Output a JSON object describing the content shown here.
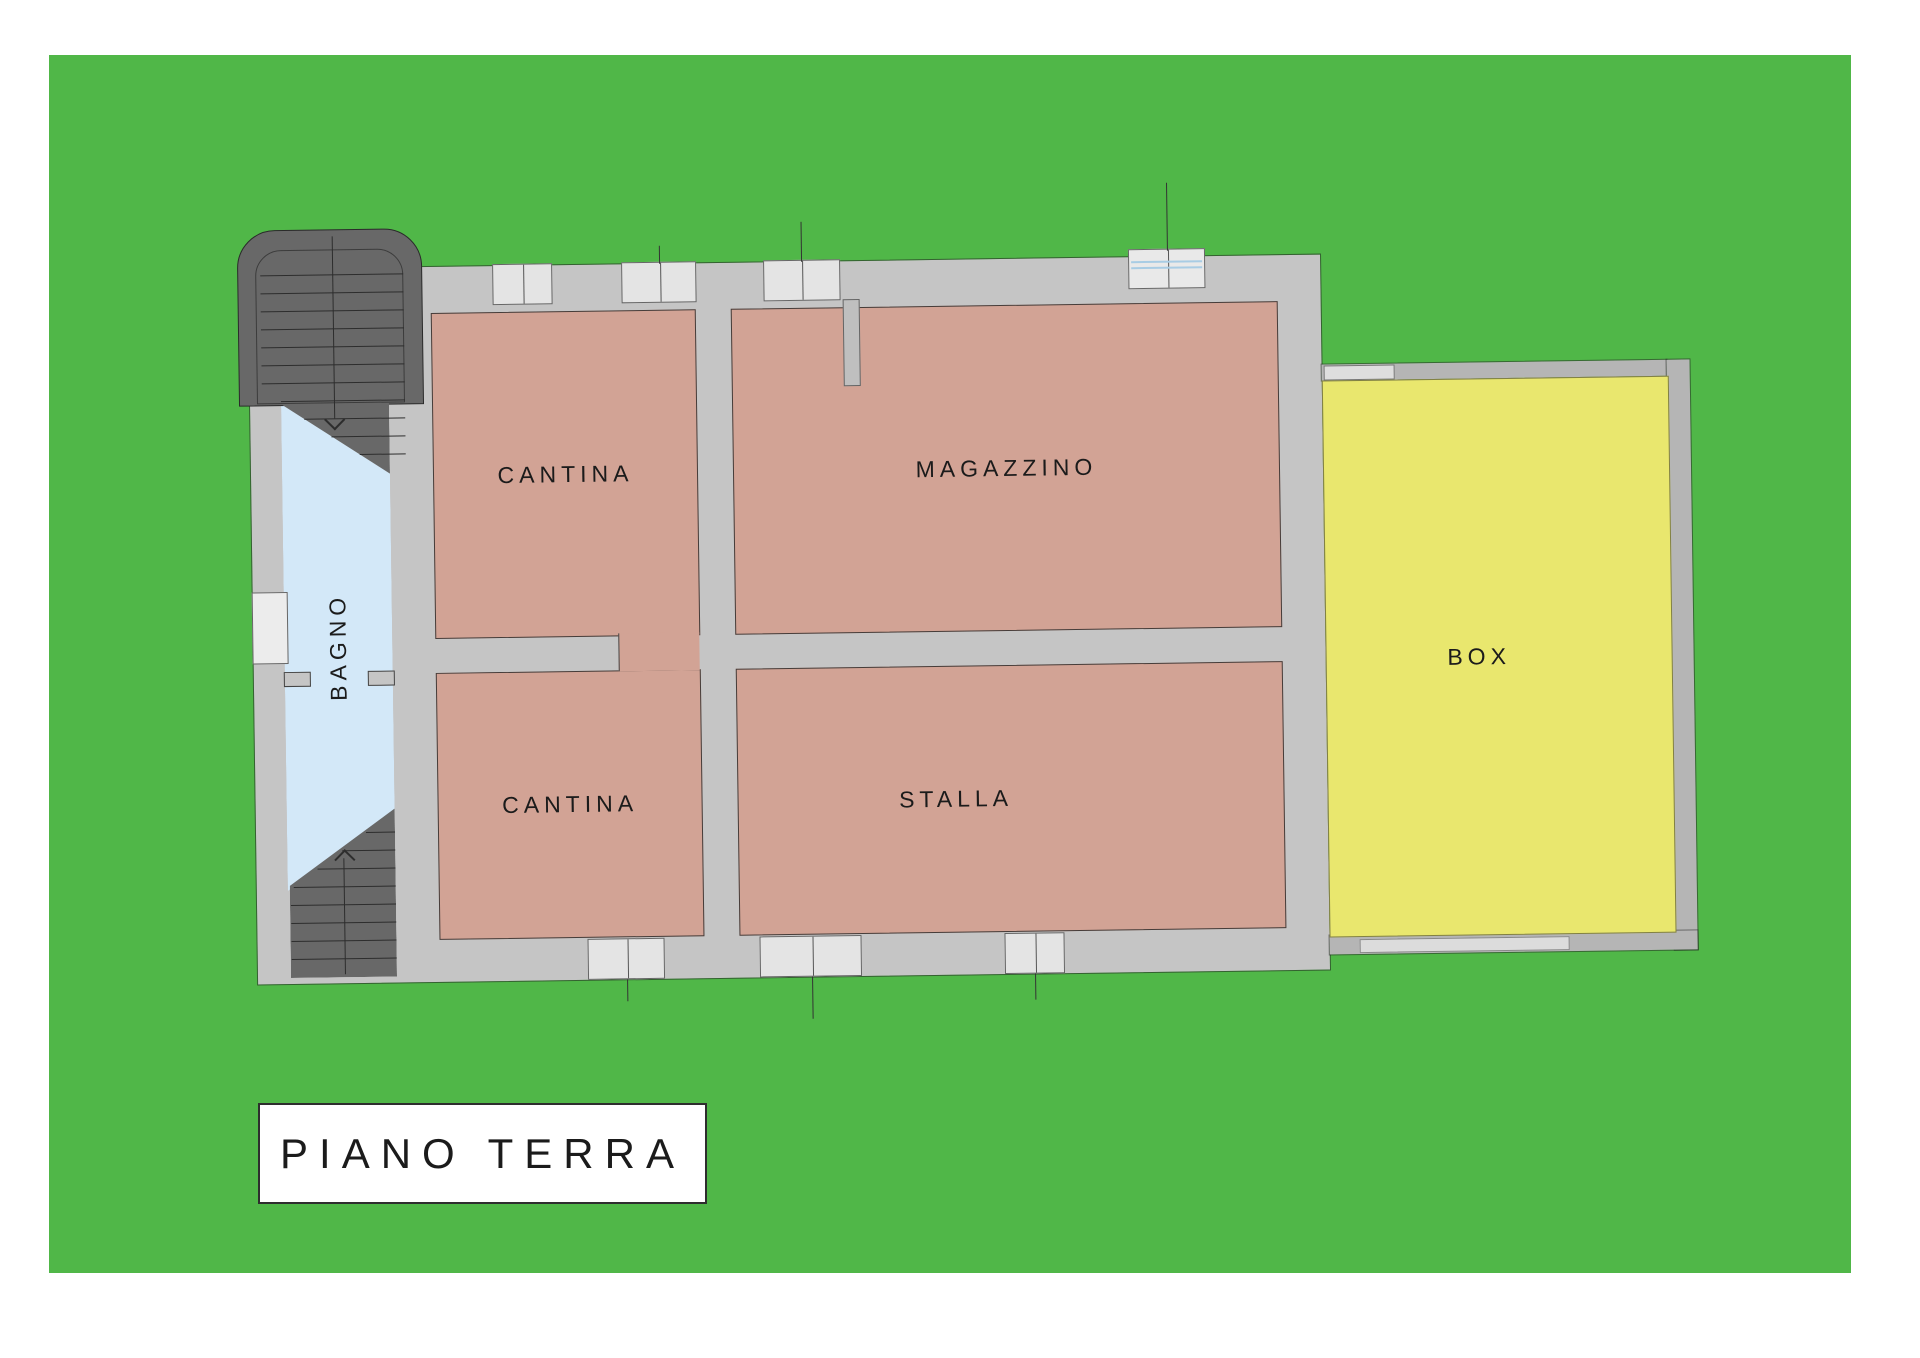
{
  "palette": {
    "page_bg": "#ffffff",
    "lawn_green": "#50b748",
    "wall_light": "#c5c5c5",
    "wall_medium": "#b5b5b5",
    "room_salmon": "#d2a395",
    "garage_yellow": "#e9e76e",
    "bath_blue": "#d3e8f8",
    "stairs_dark": "#686868",
    "window_fill": "#e4e4e4",
    "glazing_blue": "#a8cce4",
    "text": "#1b1b1b"
  },
  "plan": {
    "title": "PIANO TERRA",
    "rooms": [
      {
        "id": "cantina-top",
        "label": "CANTINA"
      },
      {
        "id": "magazzino",
        "label": "MAGAZZINO"
      },
      {
        "id": "cantina-bottom",
        "label": "CANTINA"
      },
      {
        "id": "stalla",
        "label": "STALLA"
      },
      {
        "id": "bagno",
        "label": "BAGNO"
      },
      {
        "id": "box",
        "label": "BOX"
      }
    ]
  }
}
